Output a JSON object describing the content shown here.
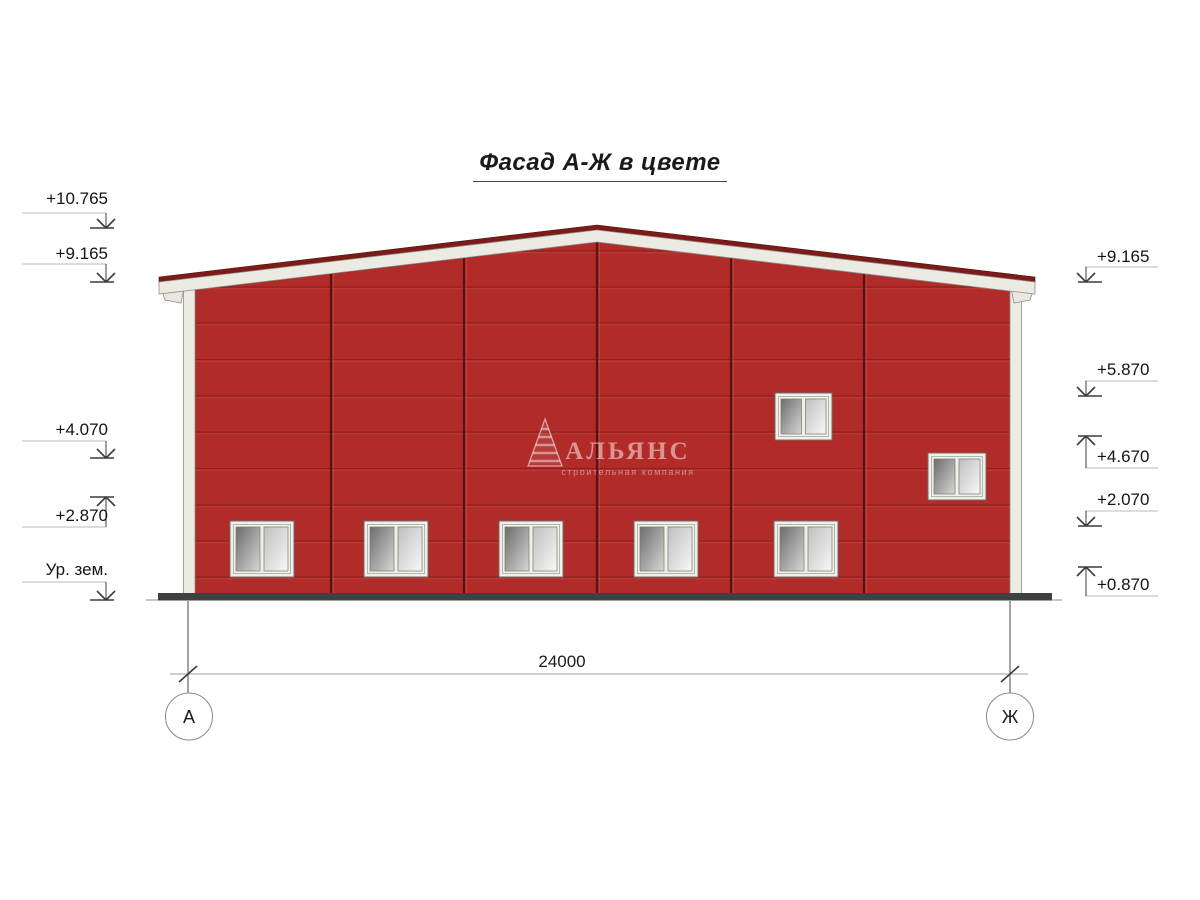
{
  "title": "Фасад А-Ж в цвете",
  "dimension_label": "24000",
  "axis_markers": [
    {
      "label": "А"
    },
    {
      "label": "Ж"
    }
  ],
  "watermark": {
    "company": "АЛЬЯНС",
    "tagline": "строительная компания"
  },
  "elevation_marks": [
    {
      "label": "+10.765",
      "side": "left",
      "text_y": 190,
      "leader_y": 213,
      "tip_y": 228,
      "dir": "down"
    },
    {
      "label": "+9.165",
      "side": "left",
      "text_y": 245,
      "leader_y": 264,
      "tip_y": 282,
      "dir": "down"
    },
    {
      "label": "+4.070",
      "side": "left",
      "text_y": 421,
      "leader_y": 441,
      "tip_y": 458,
      "dir": "down"
    },
    {
      "label": "+2.870",
      "side": "left",
      "text_y": 507,
      "leader_y": 527,
      "tip_y": 497,
      "dir": "up"
    },
    {
      "label": "Ур. зем.",
      "side": "left",
      "text_y": 561,
      "leader_y": 582,
      "tip_y": 600,
      "dir": "down"
    },
    {
      "label": "+9.165",
      "side": "right",
      "text_y": 248,
      "leader_y": 267,
      "tip_y": 282,
      "dir": "down"
    },
    {
      "label": "+5.870",
      "side": "right",
      "text_y": 361,
      "leader_y": 381,
      "tip_y": 396,
      "dir": "down"
    },
    {
      "label": "+4.670",
      "side": "right",
      "text_y": 448,
      "leader_y": 468,
      "tip_y": 436,
      "dir": "up"
    },
    {
      "label": "+2.070",
      "side": "right",
      "text_y": 491,
      "leader_y": 511,
      "tip_y": 526,
      "dir": "down"
    },
    {
      "label": "+0.870",
      "side": "right",
      "text_y": 576,
      "leader_y": 596,
      "tip_y": 567,
      "dir": "up"
    }
  ],
  "colors": {
    "facade_red": "#b12b29",
    "panel_line": "#8c1e1c",
    "joint_line": "#581210",
    "fascia": "#ecebe3",
    "roof_cap": "#7d1b18",
    "ground": "#3e4041",
    "leader_gray": "#b9b9b9",
    "mark_dark": "#3c3c3c"
  }
}
